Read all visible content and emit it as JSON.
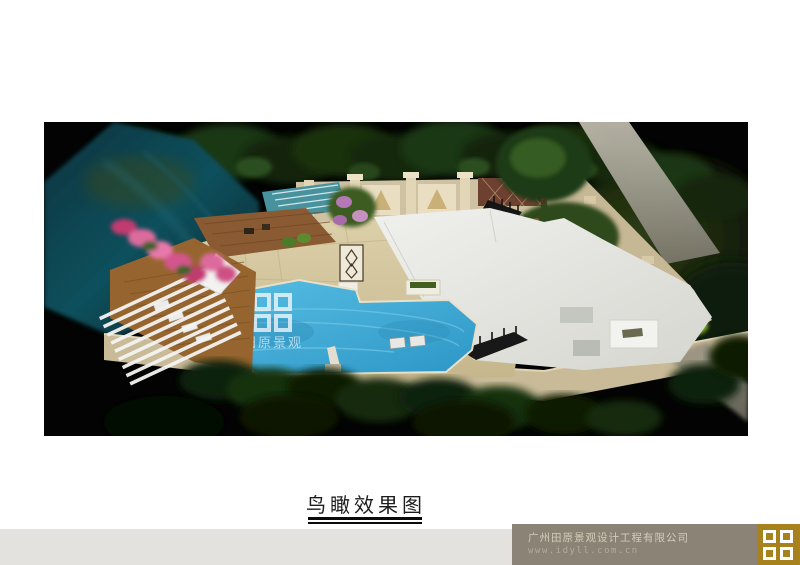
{
  "rendering": {
    "name": "aerial-view-rendering",
    "watermark": {
      "logo": "four-squares-logo",
      "text": "田原景观"
    },
    "scene_colors": {
      "background": "#020302",
      "pool_blue": "#3fa9d6",
      "paving_tan": "#d3c59e",
      "wall_beige": "#cbbc9a",
      "roof_gray": "#e7e7e3",
      "river_teal": "#11505c",
      "deck_brown": "#96652f",
      "flower_pink": "#dd6a9c"
    }
  },
  "caption": {
    "text": "鸟瞰效果图"
  },
  "footer": {
    "company_name": "广州田原景观设计工程有限公司",
    "website": "www.idyll.com.cn",
    "logo": "four-squares-logo",
    "bar_color": "#8b8476",
    "band_color": "#e3e2df",
    "logo_gold": "#a6811c"
  }
}
